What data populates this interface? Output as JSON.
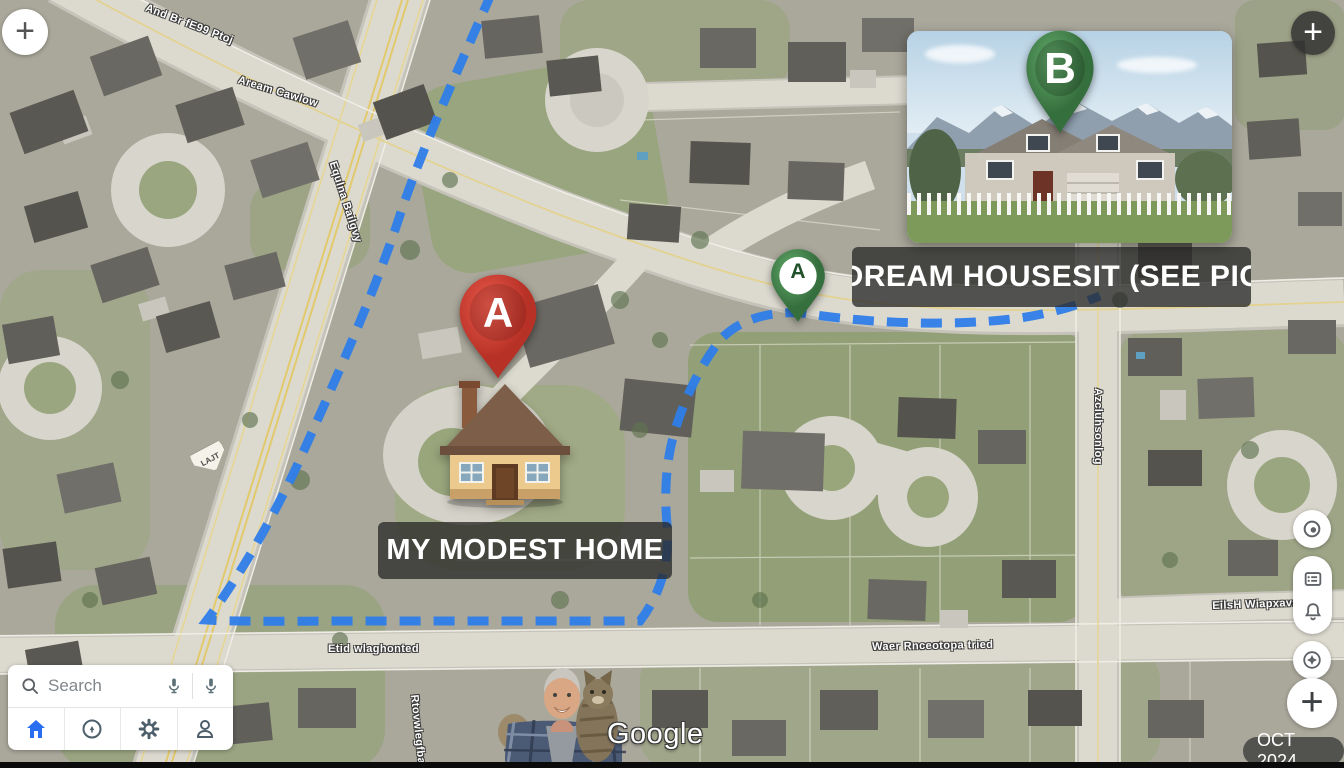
{
  "map": {
    "attribution_logo": "Google",
    "imagery_date_badge": "OCT 2024",
    "route_color": "#2e7de9",
    "street_labels": {
      "top_left_road": "And Br fE99 Ptoj",
      "upper_road": "Aream Cawlow",
      "diagonal_road": "Equlna Bailgvy",
      "right_vertical_road": "Azcluhsonlog",
      "right_lower_road": "EilsH Wiapxava",
      "bottom_road_west": "Etid wlaghonted",
      "bottom_road_east": "Waer Rnceotopa tried",
      "bottom_vertical_road": "Rtovwlegfba",
      "route_shield": "LAJT"
    },
    "markers": {
      "red_pin_letter": "A",
      "green_pin_letter": "A",
      "inset_pin_letter": "B"
    },
    "callouts": {
      "my_home": "MY MODEST HOME",
      "dream_housesit": "DREAM HOUSESIT (SEE PIC"
    }
  },
  "controls": {
    "zoom_plus_left": "+",
    "zoom_plus_right": "+",
    "zoom_plus_bottom": "+",
    "right_toolbar_icons": [
      "my-location-icon",
      "legend-icon",
      "notifications-icon",
      "compass-icon",
      "zoom-in-icon"
    ]
  },
  "search_panel": {
    "placeholder": "Search",
    "icons": {
      "search": "magnifier-icon",
      "voice_left": "mic-icon",
      "voice_right": "mic-icon",
      "home": "home-icon",
      "explore": "explore-icon",
      "settings": "gear-icon",
      "profile": "person-icon"
    }
  }
}
